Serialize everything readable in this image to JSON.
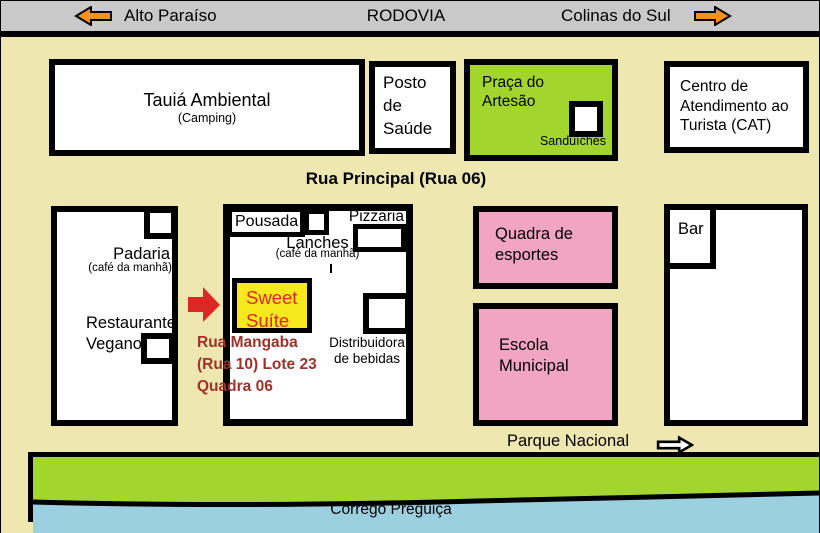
{
  "colors": {
    "beige": "#EEE7B0",
    "gray": "#C9C9C9",
    "green": "#A2D62E",
    "pink": "#F2A5C2",
    "yellow": "#F6EA1E",
    "blue": "#9CCFE0",
    "orange": "#F5921E",
    "red": "#DC2822",
    "dark-red": "#A0312A"
  },
  "road_bar": {
    "left_destination": "Alto Paraíso",
    "road": "RODOVIA",
    "right_destination": "Colinas do Sul"
  },
  "streets": {
    "main": "Rua Principal (Rua 06)",
    "address": "Rua Mangaba\n(Rua 10) Lote 23\nQuadra 06",
    "park": "Parque Nacional",
    "river": "Córrego Preguiça"
  },
  "places": {
    "camping": {
      "name": "Tauiá Ambiental",
      "sub": "(Camping)"
    },
    "health_post": {
      "name": "Posto de Saúde"
    },
    "artisan_square": {
      "name": "Praça do Artesão",
      "note": "Sanduíches"
    },
    "tourist_center": {
      "name": "Centro de Atendimento ao Turista (CAT)"
    },
    "bakery": {
      "name": "Padaria",
      "sub": "(café da manhã)"
    },
    "vegan_restaurant": {
      "name": "Restaurante Vegano"
    },
    "inn": {
      "name": "Pousada"
    },
    "snack_bar": {
      "name": "Lanches",
      "sub": "(café da manhã)"
    },
    "pizzeria": {
      "name": "Pizzaria"
    },
    "sweet_suite": {
      "name": "Sweet Suíte"
    },
    "beverage_distributor": {
      "name": "Distribuidora de bebidas"
    },
    "sports_court": {
      "name": "Quadra de esportes"
    },
    "school": {
      "name": "Escola Municipal"
    },
    "bar": {
      "name": "Bar"
    }
  }
}
